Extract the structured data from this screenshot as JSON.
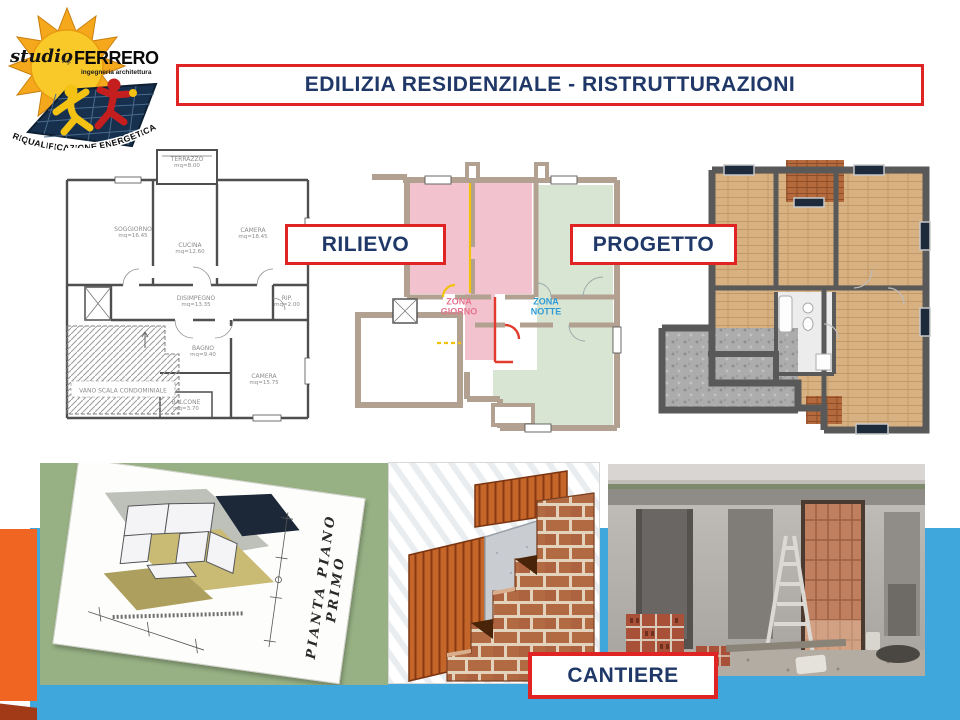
{
  "title": {
    "text": "EDILIZIA RESIDENZIALE - RISTRUTTURAZIONI"
  },
  "logo": {
    "studio": "studio",
    "ing": "ing.",
    "name": "FERRERO",
    "subtitle": "ingegneria architettura",
    "banner": "RIQUALIFICAZIONE ENERGETICA"
  },
  "tags": {
    "rilievo": "RILIEVO",
    "progetto": "PROGETTO",
    "cantiere": "CANTIERE"
  },
  "plan_rilievo": {
    "rooms": [
      {
        "name": "TERRAZZO",
        "area": "mq=8.00"
      },
      {
        "name": "SOGGIORNO",
        "area": "mq=16.45"
      },
      {
        "name": "CUCINA",
        "area": "mq=12.60"
      },
      {
        "name": "CAMERA",
        "area": "mq=18.45"
      },
      {
        "name": "DISIMPEGNO",
        "area": "mq=13.35"
      },
      {
        "name": "RIP.",
        "area": "mq=2.00"
      },
      {
        "name": "BAGNO",
        "area": "mq=9.40"
      },
      {
        "name": "CAMERA",
        "area": "mq=15.75"
      },
      {
        "name": "BALCONE",
        "area": "mq=3.70"
      },
      {
        "name": "VANO SCALA CONDOMINIALE",
        "area": ""
      }
    ]
  },
  "plan_progetto": {
    "zona_giorno": "ZONA GIORNO",
    "zona_notte": "ZONA NOTTE"
  },
  "sketch": {
    "caption": "PIANTA PIANO PRIMO"
  },
  "colors": {
    "accent_red": "#E02423",
    "navy": "#1F3868",
    "band_blue": "#3FA7DB",
    "band_teal": "#2E7E97",
    "bar_orange": "#F16522",
    "bar_maroon": "#A23A18",
    "panel_green": "#97B184",
    "plan_pink": "#F2C3CE",
    "plan_green": "#D7E5D2",
    "zona_giorno_text": "#E4738E",
    "zona_notte_text": "#2E9BD6"
  }
}
